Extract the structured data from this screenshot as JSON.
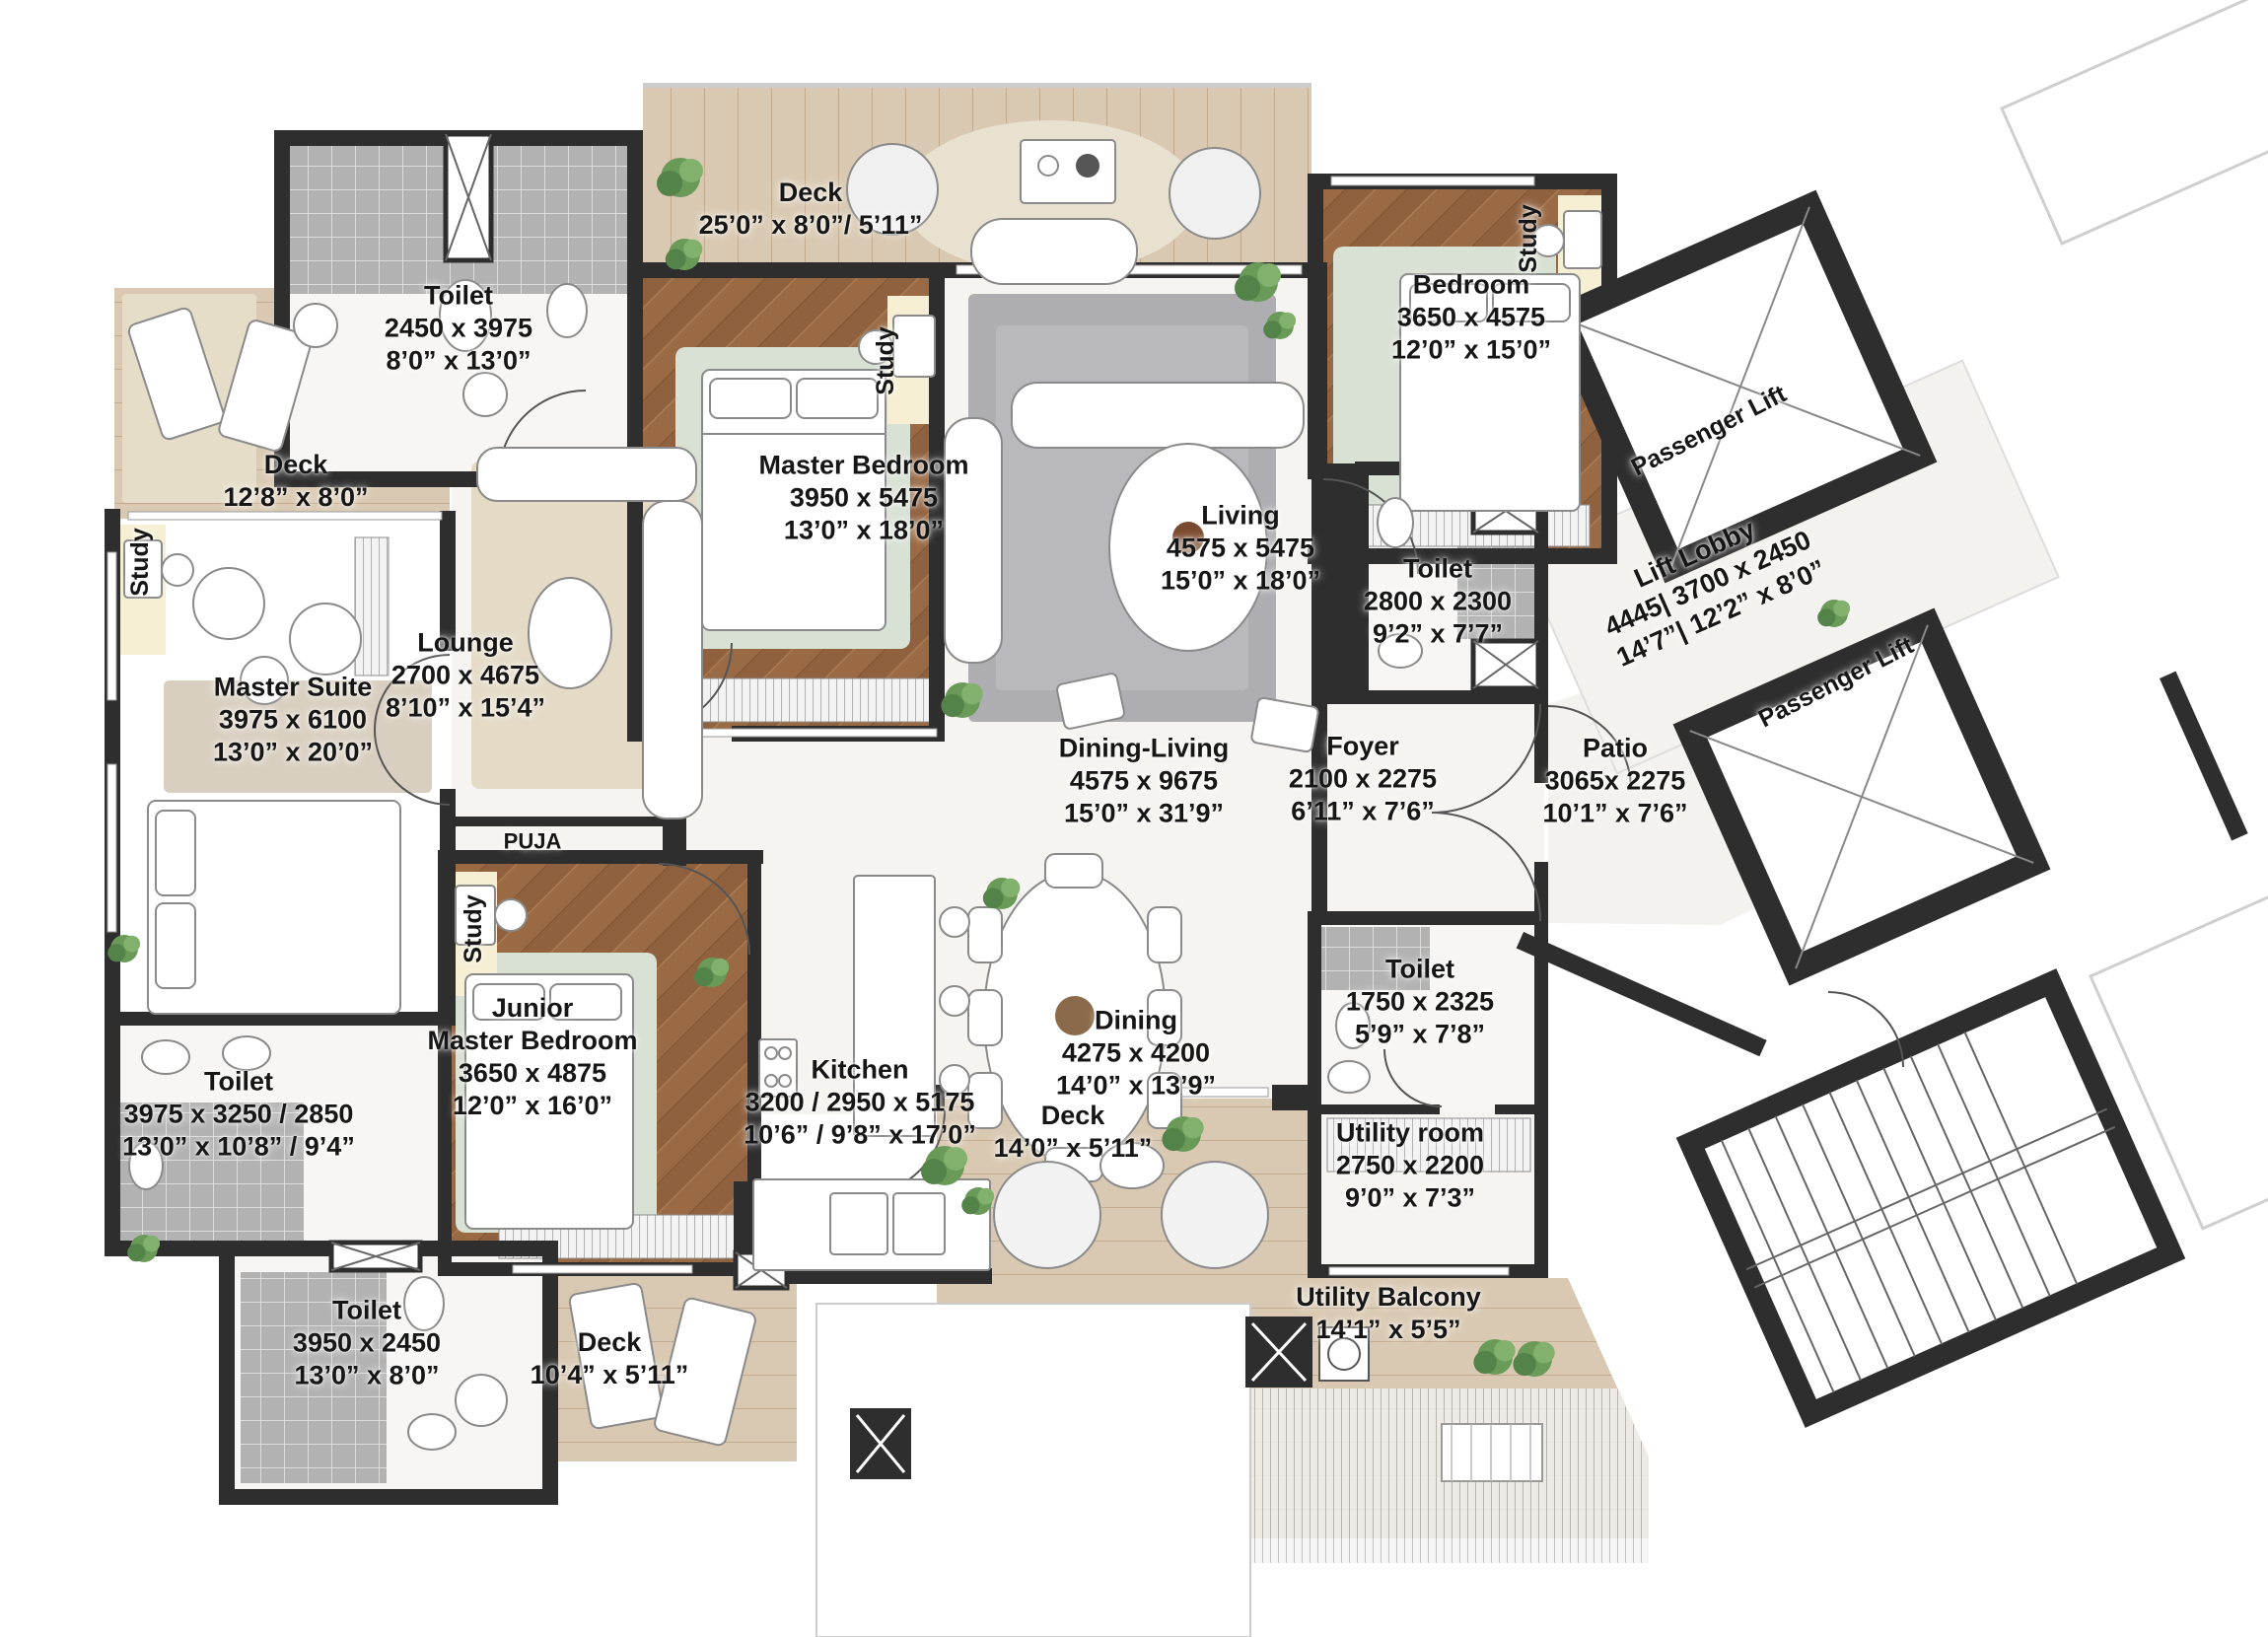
{
  "colors": {
    "wall": "#2e2e2e",
    "wood_floor": "#9a6a45",
    "deck_wood": "#d9c9b2",
    "marble": "#f5f4f1",
    "tile": "#c7c7c7",
    "rug_green": "#d9e0d4",
    "rug_beige": "#e6dcc6",
    "plant_green": "#6a9a58",
    "text": "#161616"
  },
  "labels": {
    "study": "Study",
    "puja": "PUJA",
    "passenger_lift": "Passenger Lift"
  },
  "rooms": {
    "toilet_top_left": {
      "name": "Toilet",
      "metric": "2450 x 3975",
      "imperial": "8’0” x 13’0”"
    },
    "deck_top": {
      "name": "Deck",
      "imperial": "25’0” x 8’0”/ 5’11”"
    },
    "master_bedroom": {
      "name": "Master Bedroom",
      "metric": "3950 x 5475",
      "imperial": "13’0” x 18’0”"
    },
    "bedroom": {
      "name": "Bedroom",
      "metric": "3650 x 4575",
      "imperial": "12’0” x 15’0”"
    },
    "living": {
      "name": "Living",
      "metric": "4575 x 5475",
      "imperial": "15’0” x 18’0”"
    },
    "toilet_bedroom": {
      "name": "Toilet",
      "metric": "2800 x 2300",
      "imperial": "9’2” x 7’7”"
    },
    "lift_lobby": {
      "name": "Lift Lobby",
      "metric": "4445| 3700 x 2450",
      "imperial": "14’7”| 12’2” x 8’0”"
    },
    "patio": {
      "name": "Patio",
      "metric": "3065x 2275",
      "imperial": "10’1” x 7’6”"
    },
    "foyer": {
      "name": "Foyer",
      "metric": "2100 x 2275",
      "imperial": "6’11” x 7’6”"
    },
    "dining_living": {
      "name": "Dining-Living",
      "metric": "4575 x 9675",
      "imperial": "15’0” x 31’9”"
    },
    "deck_left": {
      "name": "Deck",
      "imperial": "12’8” x 8’0”"
    },
    "master_suite": {
      "name": "Master Suite",
      "metric": "3975 x 6100",
      "imperial": "13’0” x 20’0”"
    },
    "lounge": {
      "name": "Lounge",
      "metric": "2700 x 4675",
      "imperial": "8’10” x 15’4”"
    },
    "junior_master_bedroom": {
      "name_line1": "Junior",
      "name_line2": "Master Bedroom",
      "metric": "3650 x 4875",
      "imperial": "12’0” x 16’0”"
    },
    "kitchen": {
      "name": "Kitchen",
      "metric": "3200 / 2950  x 5175",
      "imperial": "10’6” / 9’8” x 17’0”"
    },
    "dining": {
      "name": "Dining",
      "metric": "4275 x 4200",
      "imperial": "14’0” x 13’9”"
    },
    "deck_center": {
      "name": "Deck",
      "imperial": "14’0” x 5’11”"
    },
    "toilet_master_suite": {
      "name": "Toilet",
      "metric": "3975 x 3250 / 2850",
      "imperial": "13’0” x 10’8” / 9’4”"
    },
    "toilet_lower": {
      "name": "Toilet",
      "metric": "3950 x 2450",
      "imperial": "13’0” x 8’0”"
    },
    "deck_lower": {
      "name": "Deck",
      "imperial": "10’4” x 5’11”"
    },
    "toilet_utility": {
      "name": "Toilet",
      "metric": "1750 x 2325",
      "imperial": "5’9” x 7’8”"
    },
    "utility_room": {
      "name": "Utility room",
      "metric": "2750 x 2200",
      "imperial": "9’0” x 7’3”"
    },
    "utility_balcony": {
      "name": "Utility Balcony",
      "imperial": "14’1” x 5’5”"
    }
  }
}
